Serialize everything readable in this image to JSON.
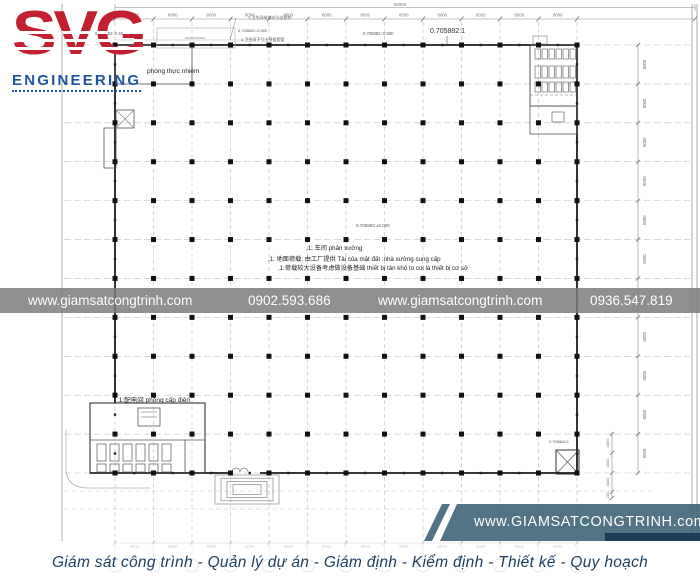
{
  "theme": {
    "logo_red": "#c21f30",
    "logo_blue": "#2053a4",
    "band_gray": "#7d7d7d",
    "badge_blue": "#3e6478",
    "footer_navy": "#1e3f63"
  },
  "logo": {
    "wordmark": "SVG",
    "subtitle": "ENGINEERING"
  },
  "watermark": {
    "items": [
      "www.giamsatcongtrinh.com",
      "0902.593.686",
      "www.giamsatcongtrinh.com",
      "0936.547.819"
    ]
  },
  "badge": {
    "url": "www.GIAMSATCONGTRINH.com"
  },
  "footer": {
    "tagline": "Giám sát công trình - Quản lý dự án - Giám định - Kiểm định - Thiết kế - Quy hoạch"
  },
  "drawing": {
    "total_label": "96000",
    "bay_label": "8000",
    "right_bay_label": "8000",
    "fine_dims": [
      "4000",
      "4000",
      "4000",
      "200"
    ],
    "room_labels": [
      {
        "x": 147,
        "y": 73,
        "fs": 6.5,
        "text": "phòng thực nhiệm"
      },
      {
        "x": 117,
        "y": 402,
        "fs": 6.5,
        "text": ",1:配电间 phòng cấp điện"
      }
    ],
    "center_notes": [
      {
        "x": 306,
        "y": 250,
        "text": ",1; 车间 phân xưởng"
      },
      {
        "x": 268,
        "y": 261,
        "text": ",1: 地面荷载: 由工厂提供  Tải của mặt đất  :nhà xưởng cung cấp"
      },
      {
        "x": 278,
        "y": 270,
        "text": ",1:荷载较大设备考虑做设备基础  thiết bị tản khó to coi là thiết bị cơ sở"
      }
    ],
    "annotations": [
      {
        "x": 95,
        "y": 35,
        "fs": 4.2,
        "text": "0.705882:-0.500"
      },
      {
        "x": 363,
        "y": 35,
        "fs": 4.2,
        "text": "0.705882:-0.500"
      },
      {
        "x": 430,
        "y": 33,
        "fs": 7,
        "text": "0.705882:1"
      },
      {
        "x": 356,
        "y": 227,
        "fs": 4.5,
        "text": "0.705882:±0.000"
      },
      {
        "x": 248,
        "y": 19,
        "fs": 4,
        "text": "1.卫生间给排水引出室外"
      },
      {
        "x": 238,
        "y": 32,
        "fs": 4,
        "text": "0.705882:-0.500"
      },
      {
        "x": 241,
        "y": 41,
        "fs": 4,
        "text": "1.卫生间下引出预留套管"
      },
      {
        "x": 549,
        "y": 443,
        "fs": 4,
        "text": "0.705882:1"
      }
    ]
  }
}
